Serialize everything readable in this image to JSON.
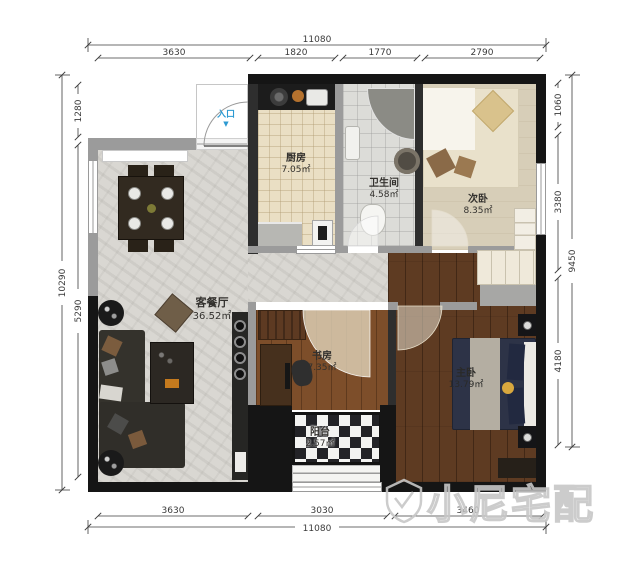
{
  "watermark": {
    "brand": "小尼宅配"
  },
  "entrance": {
    "label": "入口",
    "arrow_icon": "▼"
  },
  "rooms": {
    "living_dining": {
      "name": "客餐厅",
      "area": "36.52㎡"
    },
    "kitchen": {
      "name": "厨房",
      "area": "7.05㎡"
    },
    "bathroom": {
      "name": "卫生间",
      "area": "4.58㎡"
    },
    "secondary_bedroom": {
      "name": "次卧",
      "area": "8.35㎡"
    },
    "study": {
      "name": "书房",
      "area": "7.35㎡"
    },
    "master_bedroom": {
      "name": "主卧",
      "area": "13.79㎡"
    },
    "balcony": {
      "name": "阳台",
      "area": "2.57㎡"
    }
  },
  "dimensions": {
    "top": {
      "total": "11080",
      "segments": [
        "3630",
        "1820",
        "1770",
        "2790"
      ]
    },
    "bottom": {
      "total": "11080",
      "segments": [
        "3630",
        "3030",
        "3460"
      ]
    },
    "left": {
      "total": "10290",
      "segments": [
        "1280",
        "5290"
      ]
    },
    "right": {
      "total": "9450",
      "segments": [
        "1060",
        "3380",
        "4180"
      ]
    }
  },
  "colors": {
    "wall": "#151515",
    "partition": "#9b9b9b",
    "entrance_accent": "#2d9ad2",
    "marble_floor": "#d9d7d2",
    "kitchen_tile": "#eadfc4",
    "master_wood": "#5e3b22",
    "study_wood": "#7d4e2a",
    "bedroom_tan": "#d7ceb8"
  }
}
